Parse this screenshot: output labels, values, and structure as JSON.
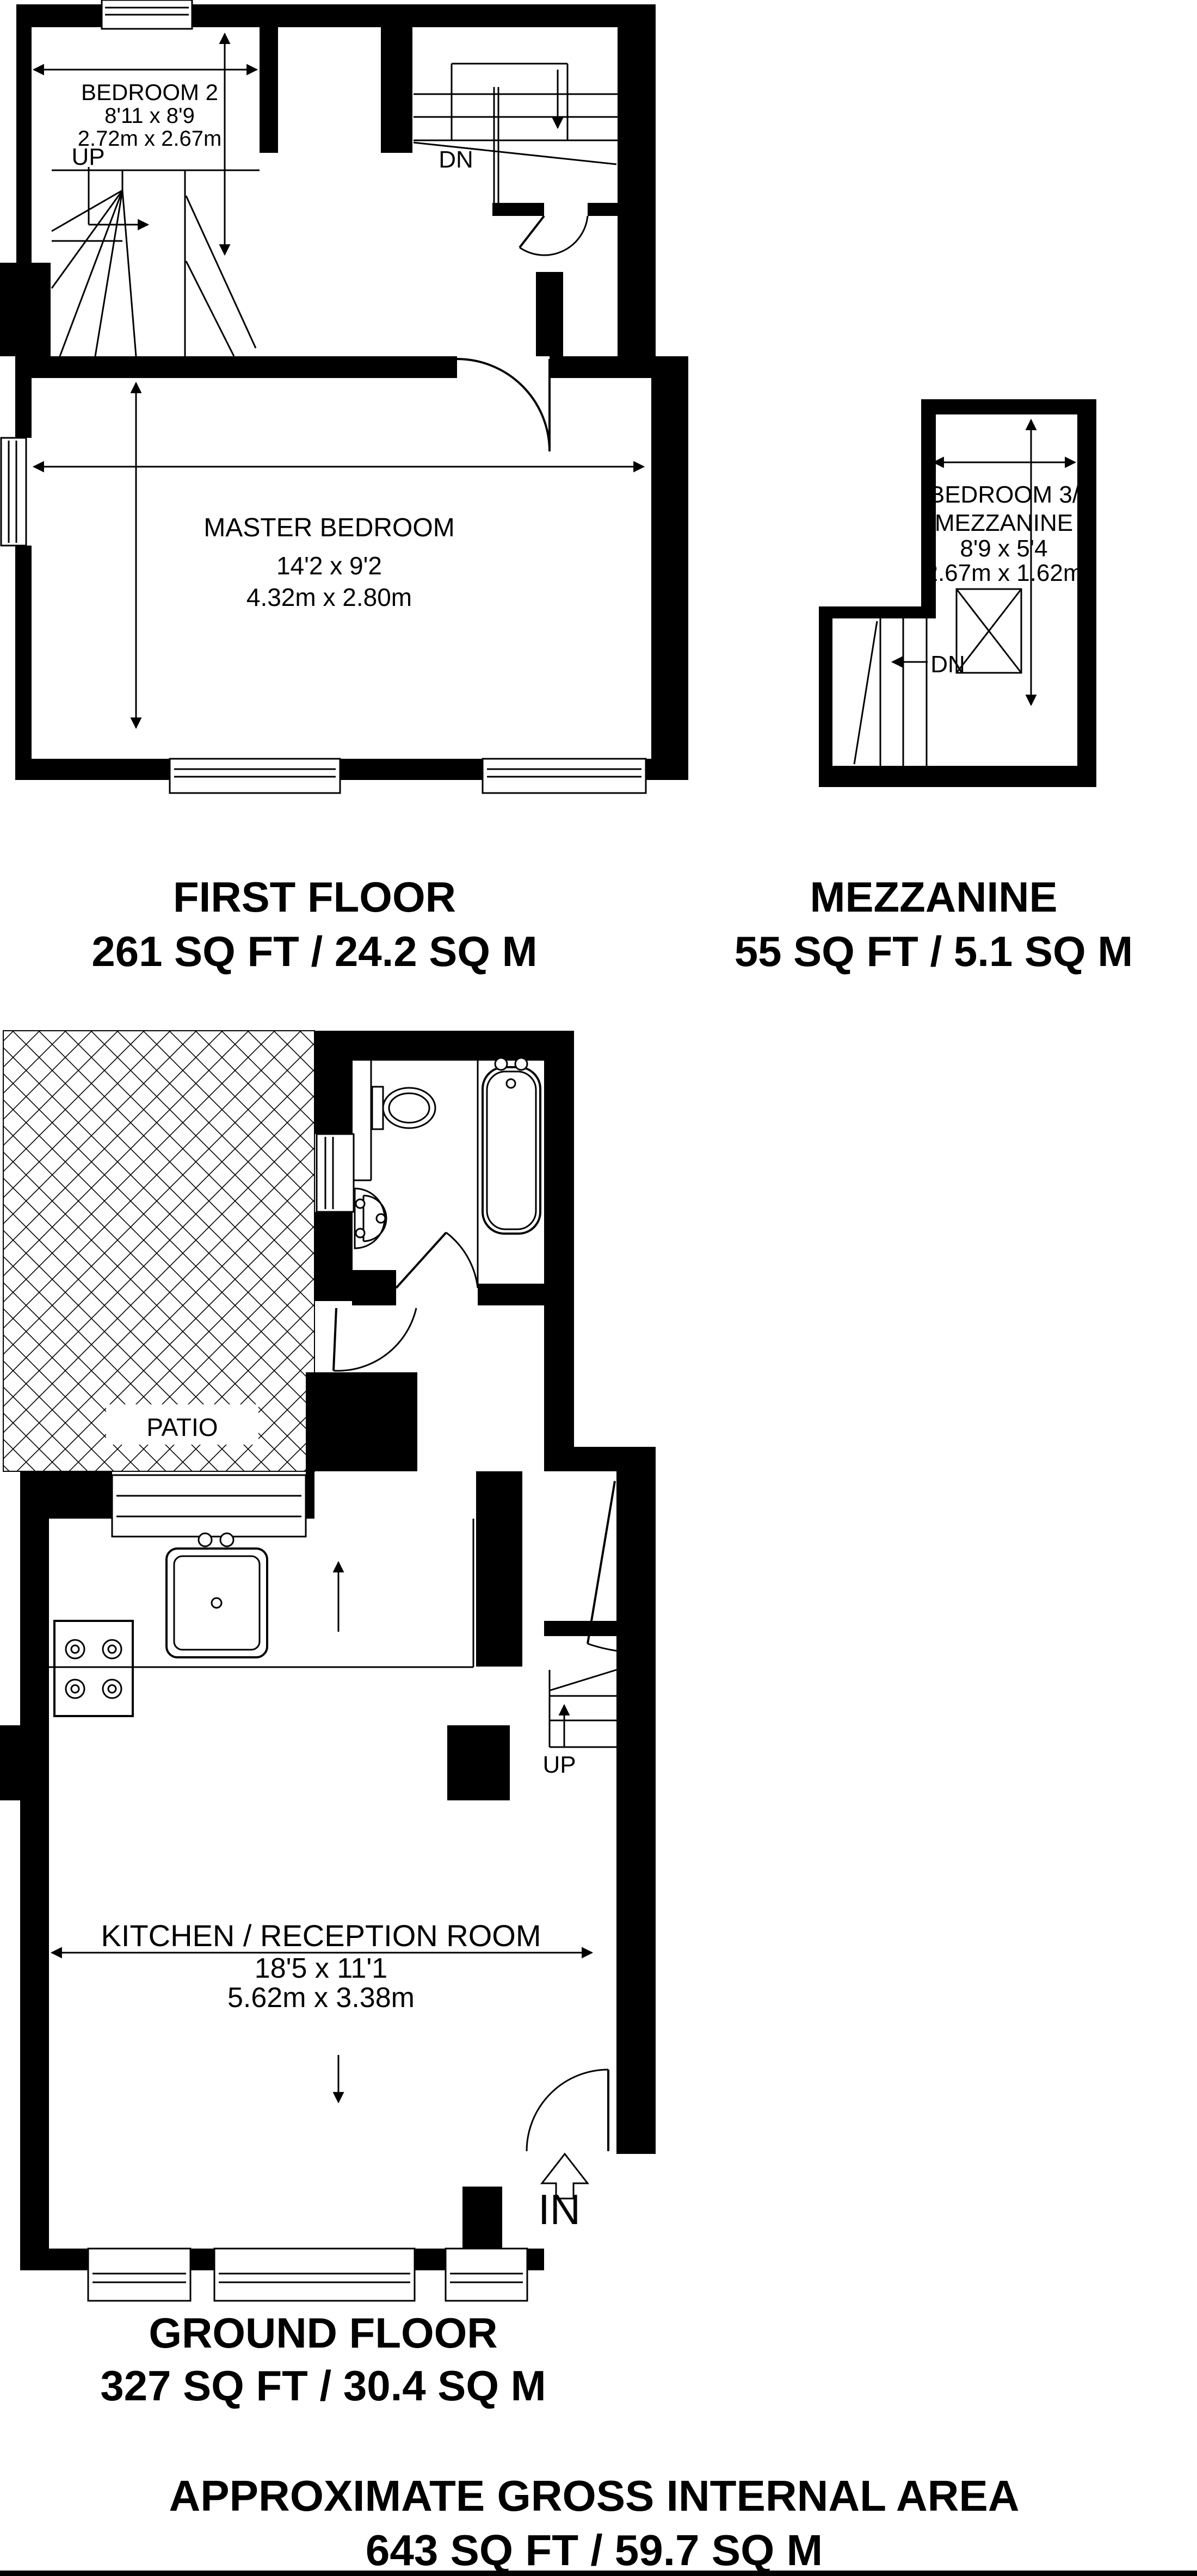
{
  "colors": {
    "ink": "#000000",
    "paper": "#ffffff"
  },
  "first_floor": {
    "title": "FIRST FLOOR",
    "area": "261 SQ FT / 24.2 SQ M",
    "bedroom2": {
      "name": "BEDROOM 2",
      "size_imperial": "8'11 x 8'9",
      "size_metric": "2.72m x 2.67m"
    },
    "master": {
      "name": "MASTER BEDROOM",
      "size_imperial": "14'2 x 9'2",
      "size_metric": "4.32m x 2.80m"
    },
    "up_label": "UP",
    "dn_label": "DN"
  },
  "mezzanine": {
    "title": "MEZZANINE",
    "area": "55 SQ FT / 5.1 SQ M",
    "bedroom3": {
      "name_line1": "BEDROOM 3/",
      "name_line2": "MEZZANINE",
      "size_imperial": "8'9 x 5'4",
      "size_metric": "2.67m x 1.62m"
    },
    "dn_label": "DN"
  },
  "ground_floor": {
    "title": "GROUND FLOOR",
    "area": "327 SQ FT / 30.4 SQ M",
    "kitchen": {
      "name": "KITCHEN / RECEPTION ROOM",
      "size_imperial": "18'5 x 11'1",
      "size_metric": "5.62m x 3.38m"
    },
    "patio": {
      "name": "PATIO"
    },
    "up_label": "UP",
    "in_label": "IN"
  },
  "footer": {
    "title": "APPROXIMATE GROSS INTERNAL AREA",
    "area": "643 SQ FT / 59.7 SQ M"
  }
}
